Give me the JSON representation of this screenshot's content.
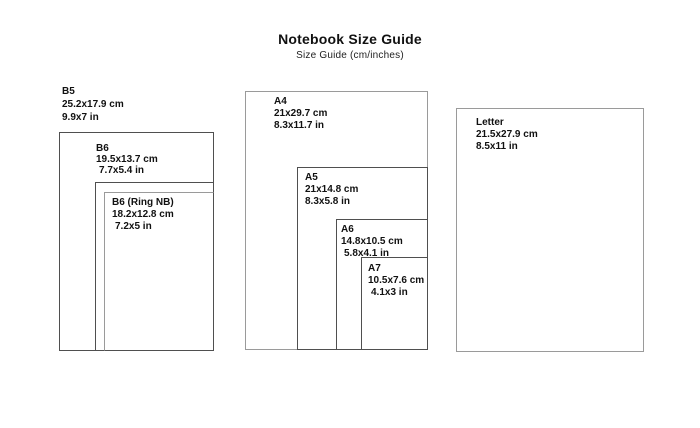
{
  "header": {
    "title": "Notebook Size Guide",
    "subtitle": "Size Guide (cm/inches)"
  },
  "sizes": [
    {
      "id": "b5",
      "name": "B5",
      "cm": "25.2x17.9 cm",
      "in": "9.9x7 in"
    },
    {
      "id": "b6",
      "name": "B6",
      "cm": "19.5x13.7 cm",
      "in": "7.7x5.4 in"
    },
    {
      "id": "b6-ring",
      "name": "B6 (Ring NB)",
      "cm": "18.2x12.8 cm",
      "in": "7.2x5 in"
    },
    {
      "id": "a4",
      "name": "A4",
      "cm": "21x29.7 cm",
      "in": "8.3x11.7 in"
    },
    {
      "id": "a5",
      "name": "A5",
      "cm": "21x14.8 cm",
      "in": "8.3x5.8 in"
    },
    {
      "id": "a6",
      "name": "A6",
      "cm": "14.8x10.5 cm",
      "in": "5.8x4.1 in"
    },
    {
      "id": "a7",
      "name": "A7",
      "cm": "10.5x7.6 cm",
      "in": "4.1x3 in"
    },
    {
      "id": "letter",
      "name": "Letter",
      "cm": "21.5x27.9 cm",
      "in": "8.5x11 in"
    }
  ],
  "colors": {
    "background": "#ffffff",
    "border_dark": "#4f4f4f",
    "border_light": "#9a9a9a",
    "text": "#111111"
  }
}
